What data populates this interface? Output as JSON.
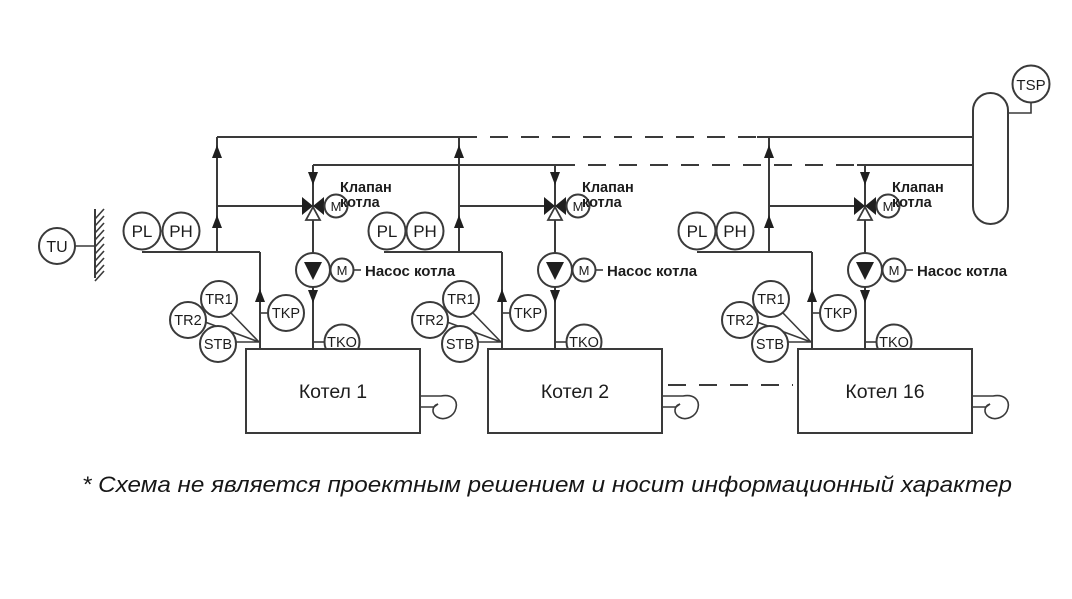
{
  "footnote": "* Схема не является проектным решением и носит информационный характер",
  "labels": {
    "valve_line1": "Клапан",
    "valve_line2": "котла",
    "pump": "Насос котла",
    "motor": "M"
  },
  "sensors": {
    "tu": "TU",
    "tsp": "TSP",
    "pl": "PL",
    "ph": "PH",
    "tr1": "TR1",
    "tr2": "TR2",
    "stb": "STB",
    "tkp": "TKP",
    "tko": "TKO"
  },
  "boilers": [
    {
      "name": "Котел 1"
    },
    {
      "name": "Котел 2"
    },
    {
      "name": "Котел 16"
    }
  ]
}
